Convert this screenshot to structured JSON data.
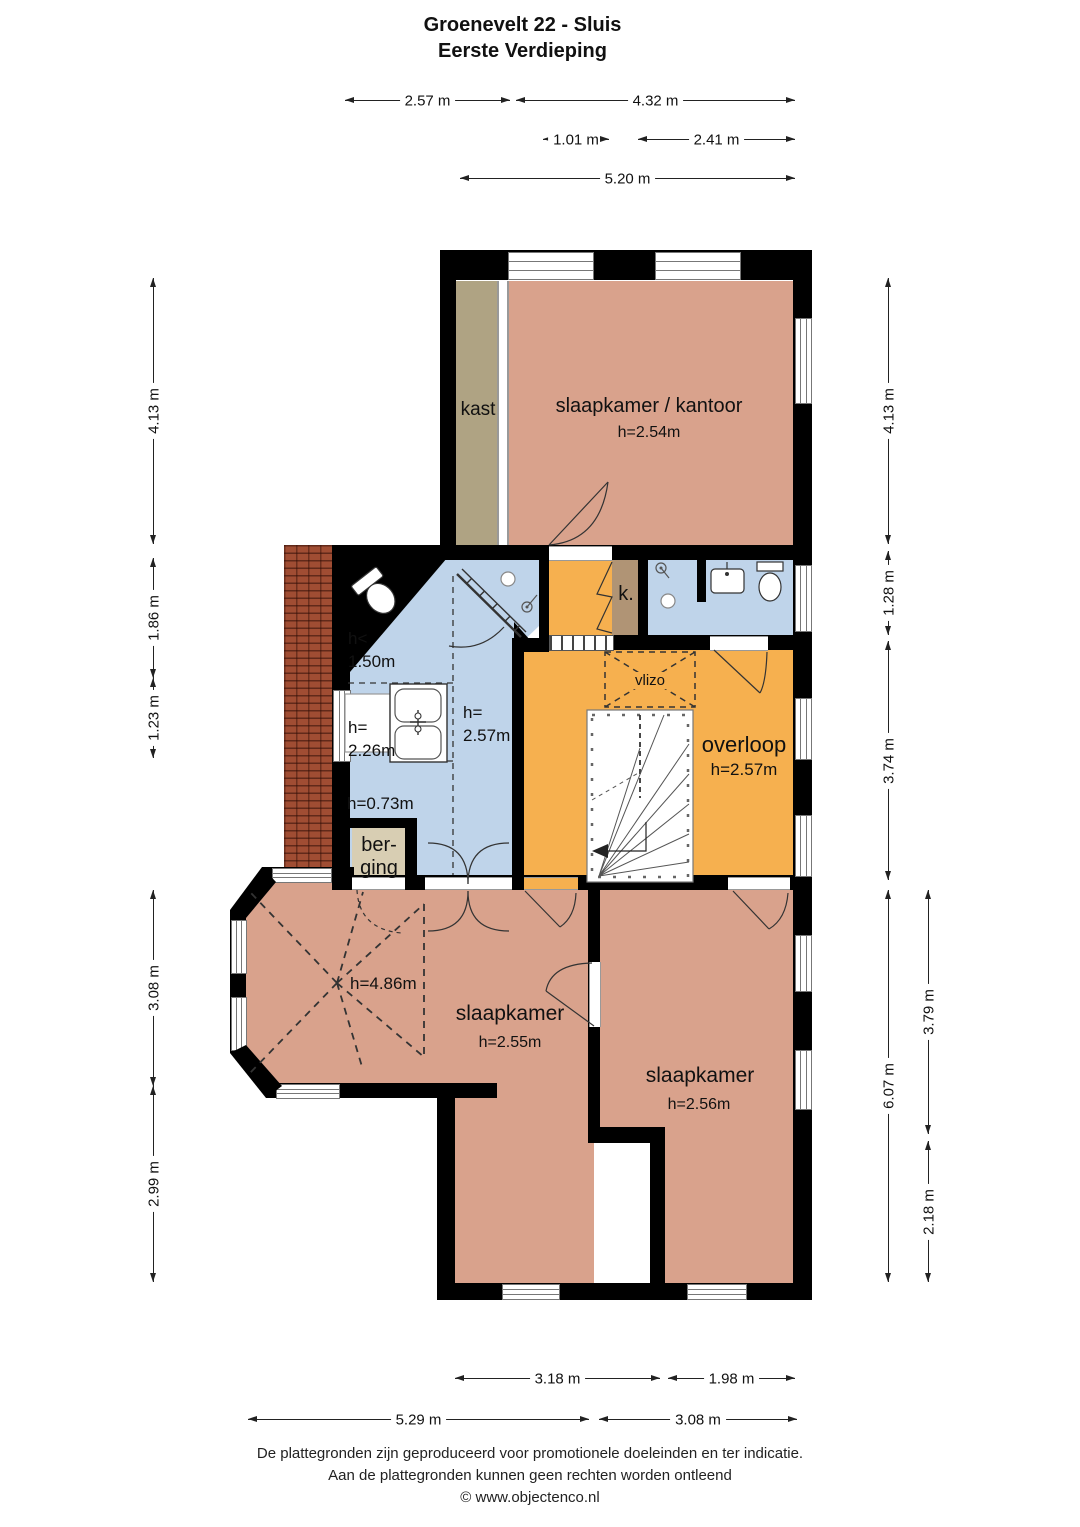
{
  "title": {
    "line1": "Groenevelt 22 - Sluis",
    "line2": "Eerste Verdieping"
  },
  "rooms": {
    "kast": "kast",
    "bedroom_office": {
      "name": "slaapkamer / kantoor",
      "height": "h=2.54m"
    },
    "bathroom": {
      "h_low_1": "h<",
      "h_low_2": "1.50m",
      "h226_1": "h=",
      "h226_2": "2.26m",
      "h257_1": "h=",
      "h257_2": "2.57m",
      "h073": "h=0.73m"
    },
    "berging": {
      "line1": "ber-",
      "line2": "ging"
    },
    "k": "k.",
    "vlizo": "vlizo",
    "overloop": {
      "name": "overloop",
      "height": "h=2.57m"
    },
    "bedroom1": {
      "name": "slaapkamer",
      "height": "h=2.55m",
      "bay_height": "h=4.86m"
    },
    "bedroom2": {
      "name": "slaapkamer",
      "height": "h=2.56m"
    }
  },
  "dims": {
    "top": [
      "2.57 m",
      "4.32 m",
      "1.01 m",
      "2.41 m",
      "5.20 m"
    ],
    "left": [
      "4.13 m",
      "1.86 m",
      "1.23 m",
      "3.08 m",
      "2.99 m"
    ],
    "right": [
      "4.13 m",
      "1.28 m",
      "3.74 m",
      "6.07 m",
      "3.79 m",
      "2.18 m"
    ],
    "bottom": [
      "3.18 m",
      "1.98 m",
      "5.29 m",
      "3.08 m"
    ]
  },
  "footer": {
    "line1": "De plattegronden zijn geproduceerd voor promotionele doeleinden en ter indicatie.",
    "line2": "Aan de plattegronden kunnen geen rechten worden ontleend",
    "line3": "© www.objectenco.nl"
  },
  "colors": {
    "room_salmon": "#D9A28C",
    "hall_orange": "#F6B04F",
    "bath_blue": "#BFD4EA",
    "closet_tan": "#AFA383",
    "berging_tan": "#D8CEB3",
    "k_closet_tan": "#B09475",
    "brick": "#A04D33",
    "wall": "#000000"
  }
}
